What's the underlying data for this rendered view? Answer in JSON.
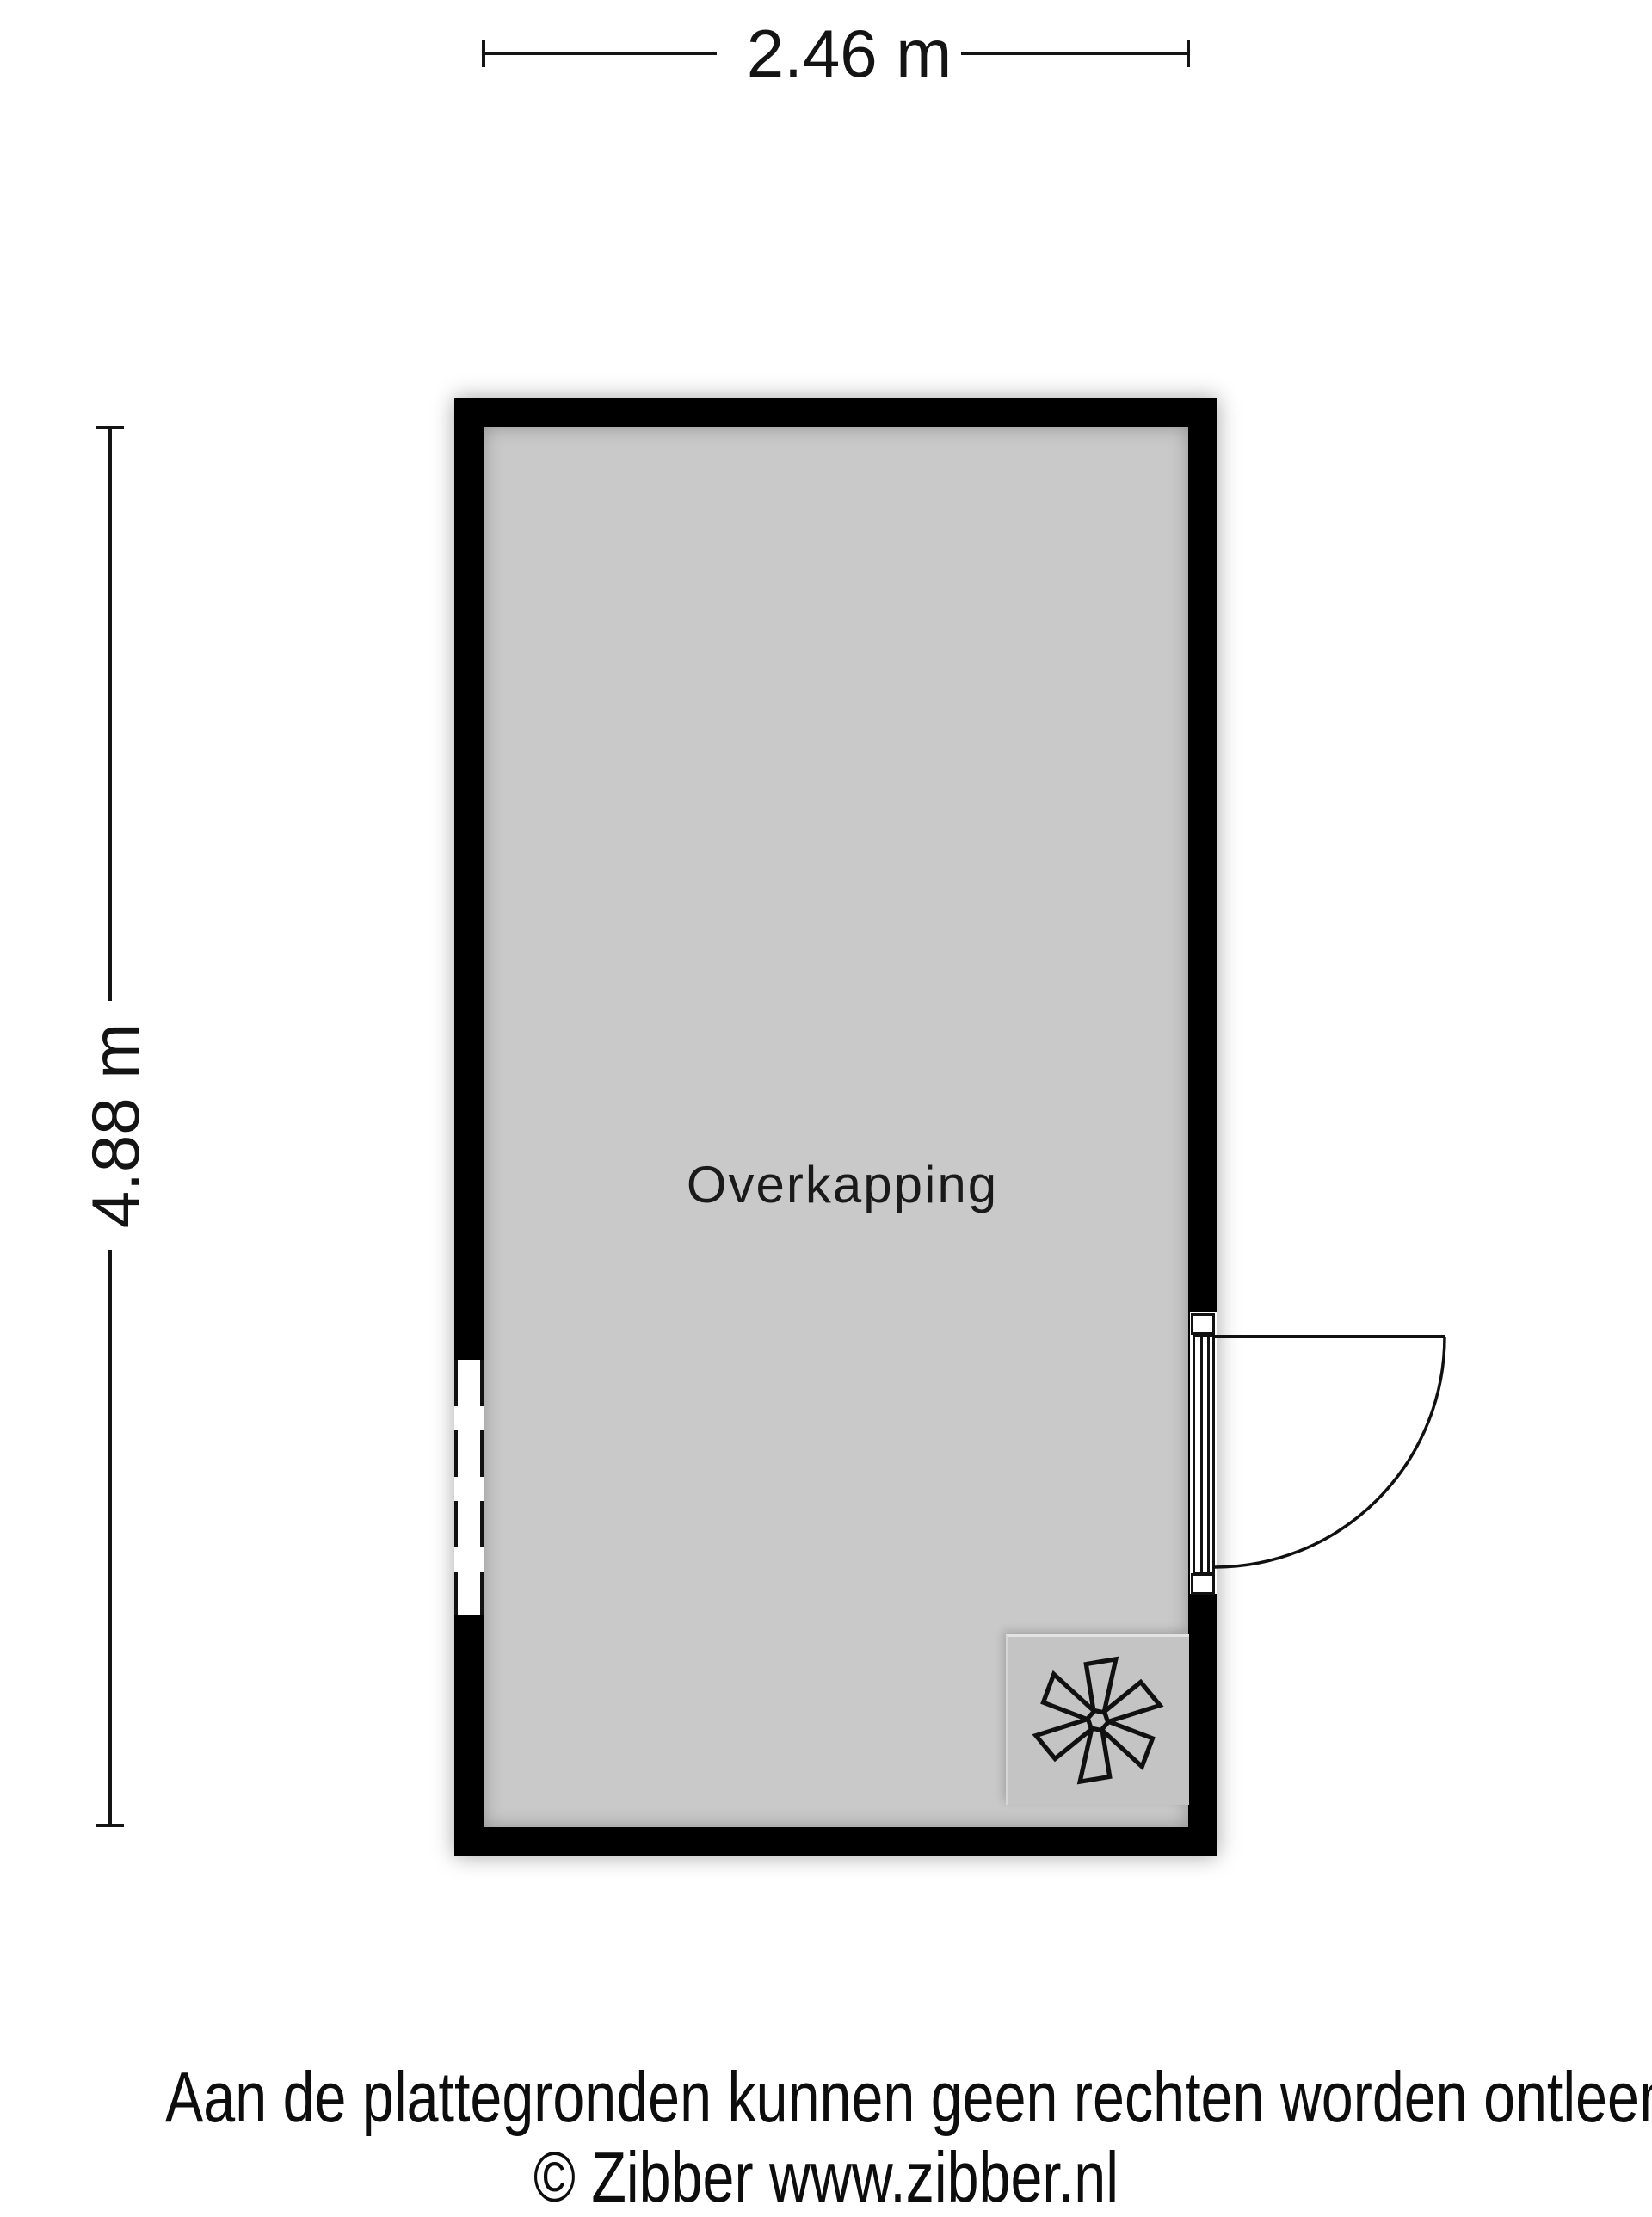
{
  "plan": {
    "room": {
      "label": "Overkapping"
    },
    "dimensions": {
      "width": {
        "label": "2.46 m"
      },
      "height": {
        "label": "4.88 m"
      }
    },
    "symbols": {
      "fan_icon": "six-blade-fan",
      "door": "right-wall-swing-door",
      "window": "left-wall-opening-dashed"
    },
    "colors": {
      "wall": "#000000",
      "floor": "#c9c9c9",
      "fan_box": "#c4c4c4",
      "dimension_line": "#141414",
      "background": "#ffffff"
    }
  },
  "footer": {
    "disclaimer": "Aan de plattegronden kunnen geen rechten worden ontleend",
    "copyright": "© Zibber www.zibber.nl"
  }
}
